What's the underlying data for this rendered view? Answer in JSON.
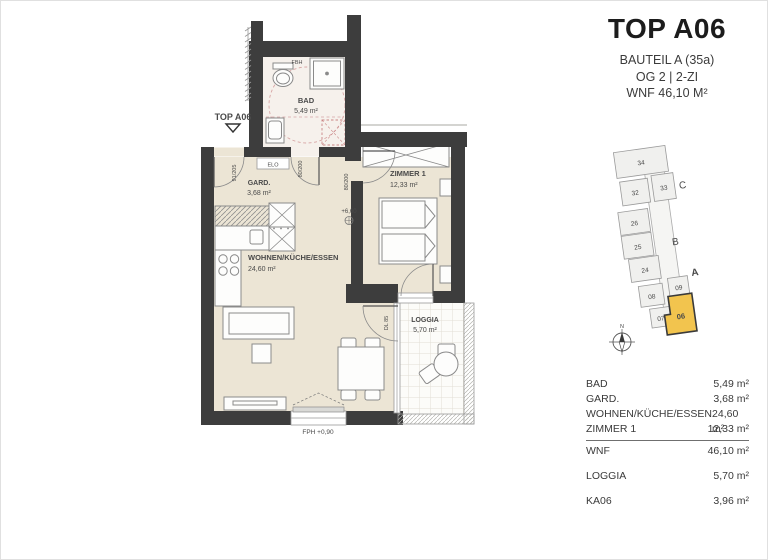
{
  "header": {
    "title": "TOP A06",
    "line1": "BAUTEIL A (35a)",
    "line2": "OG 2   |   2-ZI",
    "line3": "WNF 46,10 M²"
  },
  "plan": {
    "entrance_label": "TOP A06",
    "rooms": {
      "bad": {
        "name": "BAD",
        "area": "5,49 m²"
      },
      "gard": {
        "name": "GARD.",
        "area": "3,68 m²"
      },
      "wohnen": {
        "name": "WOHNEN/KÜCHE/ESSEN",
        "area": "24,60 m²"
      },
      "zimmer": {
        "name": "ZIMMER 1",
        "area": "12,33 m²"
      },
      "loggia": {
        "name": "LOGGIA",
        "area": "5,70 m²"
      }
    },
    "annotations": {
      "fbh": "FBH",
      "elo": "ELO",
      "entrance_door": "91/205",
      "bath_door": "80/200",
      "zimmer_door": "80/200",
      "loggia_door": "DL 85",
      "level": "+6,60",
      "floor_level": "FPH +0,90"
    },
    "colors": {
      "wall": "#3d3d3d",
      "floor": "#ece5d5",
      "bath_floor": "#f6f1ec",
      "accessibility": "#d49b9b"
    }
  },
  "sitemap": {
    "units": {
      "u34": "34",
      "u32": "32",
      "u33": "33",
      "u26": "26",
      "u25": "25",
      "u24": "24",
      "u08": "08",
      "u09": "09",
      "u07": "07",
      "u06": "06"
    },
    "sections": {
      "a": "A",
      "b": "B",
      "c": "C"
    },
    "compass": "N",
    "highlight_color": "#f2c44e"
  },
  "table": {
    "rows": [
      {
        "label": "BAD",
        "value": "5,49 m²"
      },
      {
        "label": "GARD.",
        "value": "3,68 m²"
      },
      {
        "label": "WOHNEN/KÜCHE/ESSEN",
        "value": "24,60 m²"
      },
      {
        "label": "ZIMMER 1",
        "value": "12,33 m²"
      }
    ],
    "total": {
      "label": "WNF",
      "value": "46,10 m²"
    },
    "loggia": {
      "label": "LOGGIA",
      "value": "5,70 m²"
    },
    "ka": {
      "label": "KA06",
      "value": "3,96 m²"
    }
  }
}
